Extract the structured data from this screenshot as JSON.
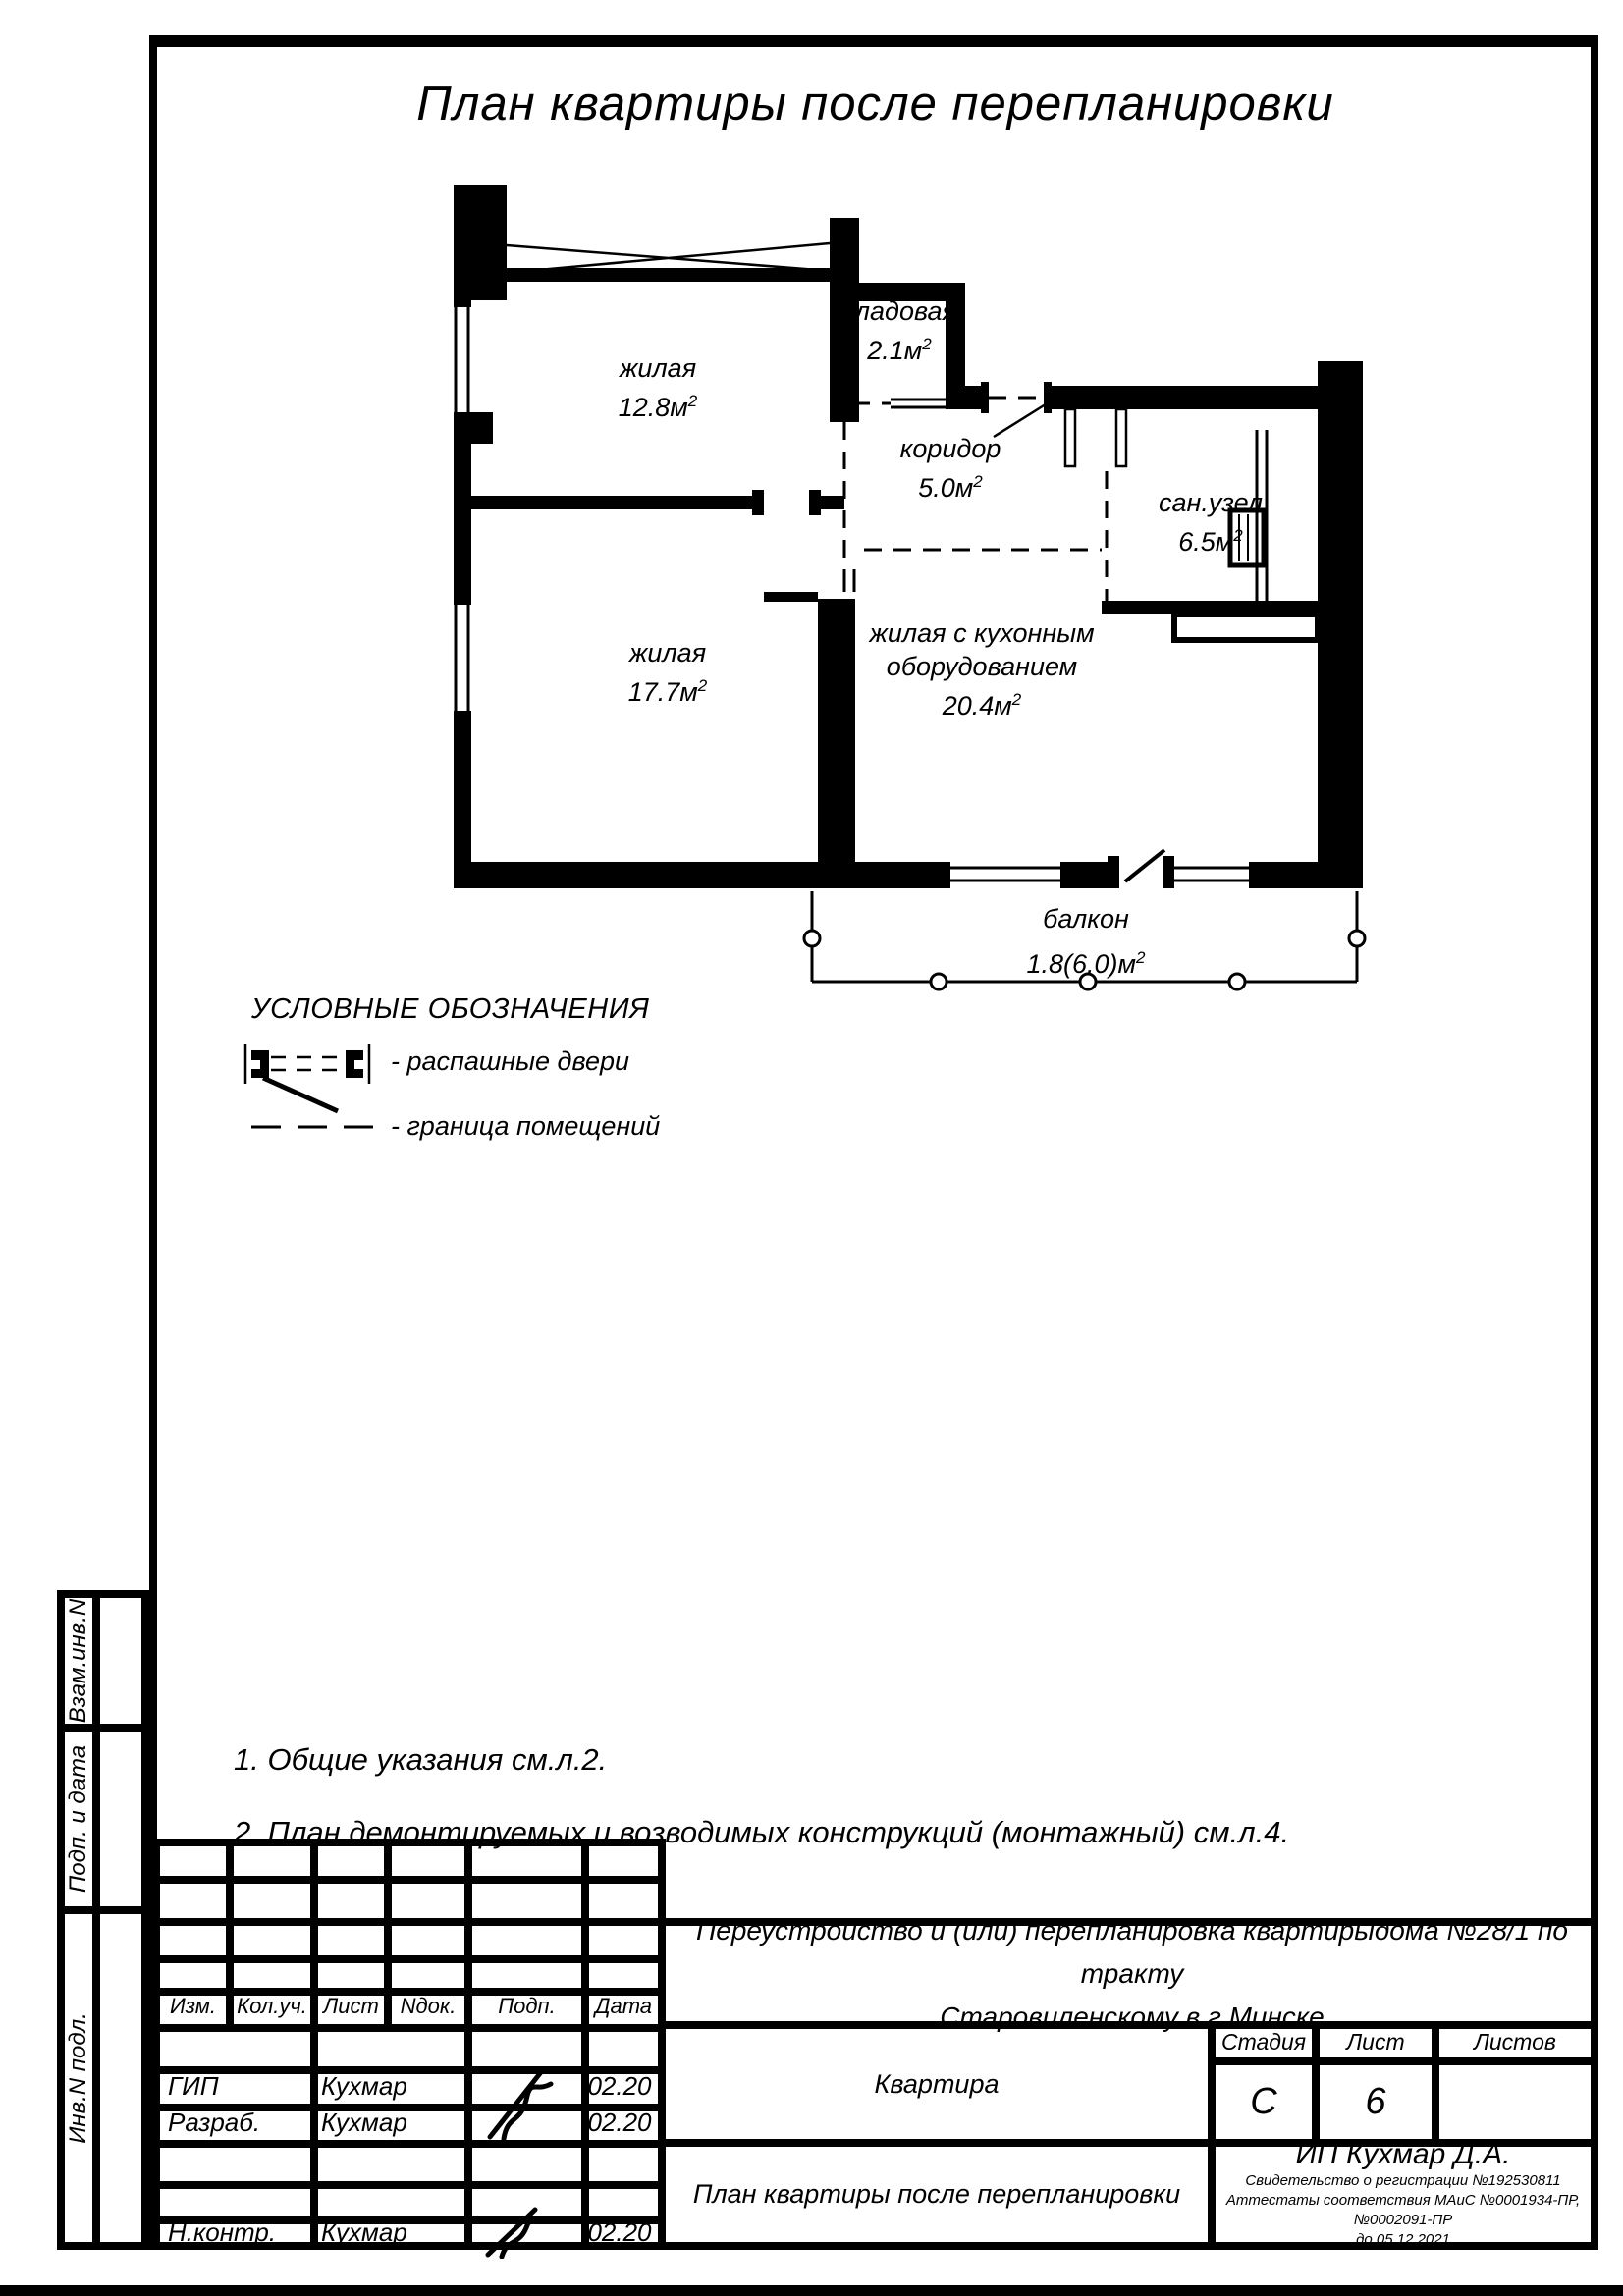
{
  "page_title": "План квартиры после перепланировки",
  "plan": {
    "sup": "2",
    "rooms": [
      {
        "name": "жилая",
        "area": "12.8м"
      },
      {
        "name": "кладовая",
        "area": "2.1м"
      },
      {
        "name": "коридор",
        "area": "5.0м"
      },
      {
        "name": "сан.узел",
        "area": "6.5м"
      },
      {
        "name": "жилая",
        "area": "17.7м"
      },
      {
        "name": "жилая с кухонным оборудованием",
        "area": "20.4м"
      },
      {
        "name": "балкон",
        "area": "1.8(6.0)м"
      }
    ]
  },
  "legend": {
    "title": "УСЛОВНЫЕ ОБОЗНАЧЕНИЯ",
    "items": [
      {
        "label": "- распашные двери"
      },
      {
        "label": "- граница помещений"
      }
    ]
  },
  "notes": [
    "1. Общие указания см.л.2.",
    "2. План демонтируемых и возводимых конструкций (монтажный) см.л.4."
  ],
  "stamp": {
    "rev_header": [
      "Изм.",
      "Кол.уч.",
      "Лист",
      "Nдок.",
      "Подп.",
      "Дата"
    ],
    "signature_rows": [
      {
        "role": "ГИП",
        "name": "Кухмар",
        "date": "02.20"
      },
      {
        "role": "Разраб.",
        "name": "Кухмар",
        "date": "02.20"
      },
      {
        "role": "Н.контр.",
        "name": "Кухмар",
        "date": "02.20"
      }
    ],
    "project_line1": "Переустройство и (или) перепланировка квартирыдома №28/1 по тракту",
    "project_line2": "Старовиленскому в г.Минске",
    "object": "Квартира",
    "stage_label": "Стадия",
    "stage": "С",
    "sheet_label": "Лист",
    "sheet": "6",
    "sheets_label": "Листов",
    "sheets": "",
    "drawing_title": "План квартиры после перепланировки",
    "company": "ИП Кухмар Д.А.",
    "cert_line1": "Свидетельство о регистрации №192530811",
    "cert_line2": "Аттестаты соответствия МАиС №0001934-ПР, №0002091-ПР",
    "cert_line3": "до 05.12.2021"
  },
  "margin_labels": [
    "Взам.инв.N",
    "Подп. и дата",
    "Инв.N подл."
  ]
}
